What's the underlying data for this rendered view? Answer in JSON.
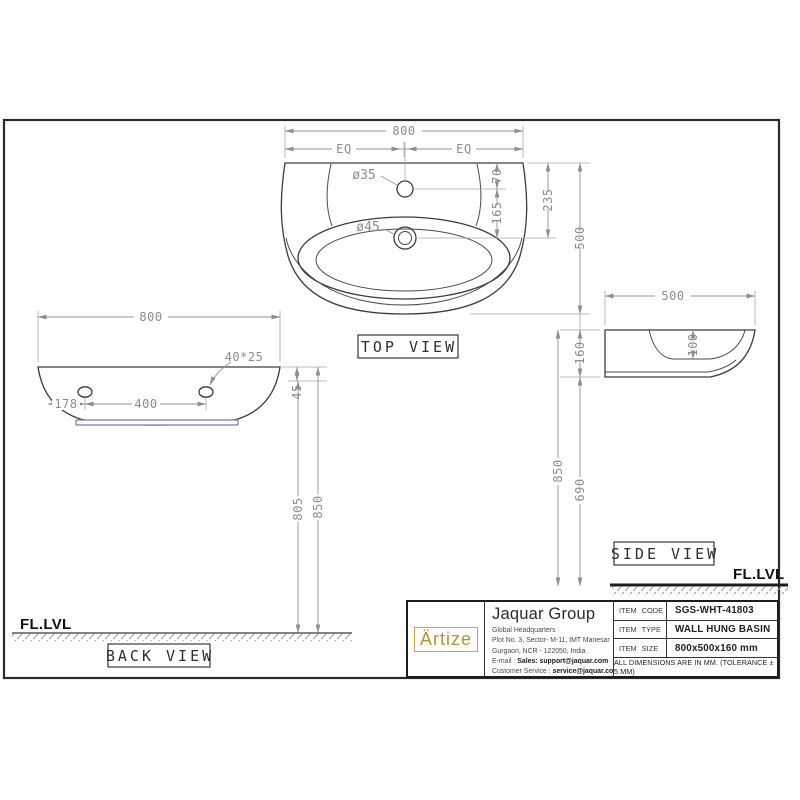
{
  "colors": {
    "object_line": "#3c3c3c",
    "dimension_gray": "#8c8c8c",
    "frame_black": "#2b2b2b",
    "gasket_blue": "#7878b4",
    "brand_gold": "#b8922e"
  },
  "views": {
    "top": {
      "label": "TOP VIEW",
      "dim_width": "800",
      "dim_eq_left": "EQ",
      "dim_eq_right": "EQ",
      "tap_hole": "ø35",
      "drain_hole": "ø45",
      "dim_top_to_tap": "70",
      "dim_tap_to_drain": "165",
      "dim_top_to_drain": "235",
      "dim_depth": "500"
    },
    "back": {
      "label": "BACK VIEW",
      "floor": "FL.LVL",
      "dim_width": "800",
      "slot_size": "40*25",
      "dim_edge_to_hole": "178",
      "dim_hole_spacing": "400",
      "dim_top_to_hole": "45",
      "dim_hole_to_floor": "805",
      "dim_top_to_floor": "850"
    },
    "side": {
      "label": "SIDE VIEW",
      "floor": "FL.LVL",
      "dim_depth": "500",
      "dim_height": "160",
      "dim_bowl_depth": "100",
      "dim_bottom_to_floor": "690",
      "dim_top_to_floor": "850"
    }
  },
  "title_block": {
    "brand": "Ärtize",
    "company": "Jaquar Group",
    "address": [
      "Global Headquarters",
      "Plot No. 3, Sector- M-11, IMT Manesar",
      "Gurgaon, NCR - 122050, India"
    ],
    "email_prefix": "E-mail : ",
    "email": "Sales: support@jaquar.com",
    "service_prefix": "Customer Service : ",
    "service": "service@jaquar.com",
    "items": [
      {
        "label": "ITEM CODE",
        "value": "SGS-WHT-41803"
      },
      {
        "label": "ITEM TYPE",
        "value": "WALL HUNG BASIN"
      },
      {
        "label": "ITEM SIZE",
        "value": "800x500x160 mm"
      }
    ],
    "tolerance": "ALL DIMENSIONS ARE IN MM. (TOLERANCE ± 5 MM)"
  }
}
